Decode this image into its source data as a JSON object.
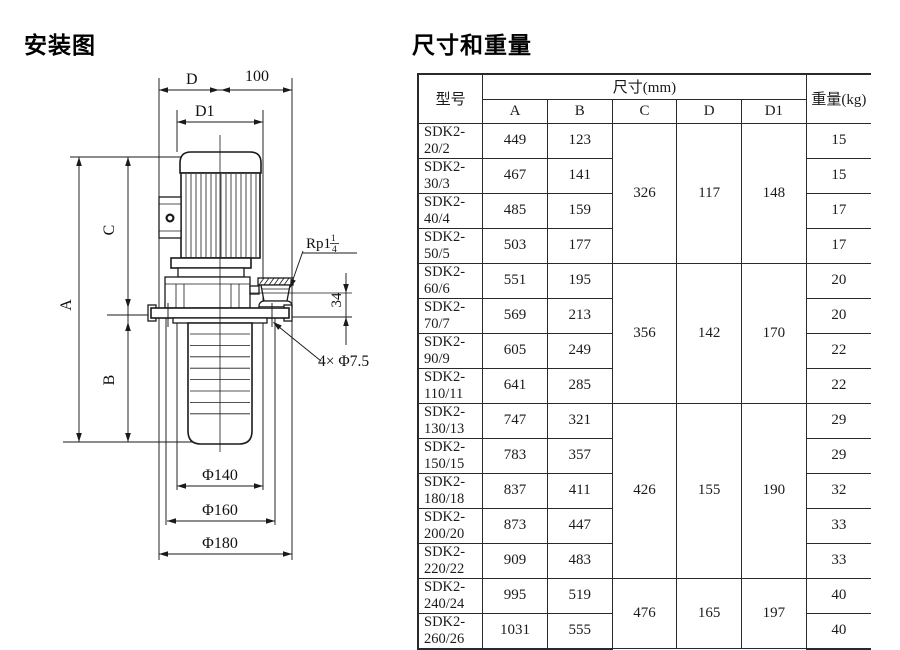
{
  "titles": {
    "diagram": "安装图",
    "table": "尺寸和重量"
  },
  "drawing": {
    "dim_d": "D",
    "dim_100": "100",
    "dim_d1": "D1",
    "dim_a": "A",
    "dim_b": "B",
    "dim_c": "C",
    "dim_34": "34",
    "rp_prefix": "Rp1",
    "rp_num": "1",
    "rp_den": "4",
    "bolt_note": "4× Φ7.5",
    "phi140": "Φ140",
    "phi160": "Φ160",
    "phi180": "Φ180"
  },
  "table": {
    "header": {
      "model": "型号",
      "size": "尺寸(mm)",
      "weight": "重量(kg)",
      "dims": [
        "A",
        "B",
        "C",
        "D",
        "D1"
      ]
    },
    "rows": [
      {
        "model": "SDK2-20/2",
        "a": "449",
        "b": "123",
        "weight": "15"
      },
      {
        "model": "SDK2-30/3",
        "a": "467",
        "b": "141",
        "weight": "15"
      },
      {
        "model": "SDK2-40/4",
        "a": "485",
        "b": "159",
        "weight": "17"
      },
      {
        "model": "SDK2-50/5",
        "a": "503",
        "b": "177",
        "weight": "17"
      },
      {
        "model": "SDK2-60/6",
        "a": "551",
        "b": "195",
        "weight": "20"
      },
      {
        "model": "SDK2-70/7",
        "a": "569",
        "b": "213",
        "weight": "20"
      },
      {
        "model": "SDK2-90/9",
        "a": "605",
        "b": "249",
        "weight": "22"
      },
      {
        "model": "SDK2-110/11",
        "a": "641",
        "b": "285",
        "weight": "22"
      },
      {
        "model": "SDK2-130/13",
        "a": "747",
        "b": "321",
        "weight": "29"
      },
      {
        "model": "SDK2-150/15",
        "a": "783",
        "b": "357",
        "weight": "29"
      },
      {
        "model": "SDK2-180/18",
        "a": "837",
        "b": "411",
        "weight": "32"
      },
      {
        "model": "SDK2-200/20",
        "a": "873",
        "b": "447",
        "weight": "33"
      },
      {
        "model": "SDK2-220/22",
        "a": "909",
        "b": "483",
        "weight": "33"
      },
      {
        "model": "SDK2-240/24",
        "a": "995",
        "b": "519",
        "weight": "40"
      },
      {
        "model": "SDK2-260/26",
        "a": "1031",
        "b": "555",
        "weight": "40"
      }
    ],
    "groups": [
      {
        "start": 0,
        "span": 4,
        "c": "326",
        "d": "117",
        "d1": "148"
      },
      {
        "start": 4,
        "span": 4,
        "c": "356",
        "d": "142",
        "d1": "170"
      },
      {
        "start": 8,
        "span": 5,
        "c": "426",
        "d": "155",
        "d1": "190"
      },
      {
        "start": 13,
        "span": 2,
        "c": "476",
        "d": "165",
        "d1": "197"
      }
    ]
  }
}
